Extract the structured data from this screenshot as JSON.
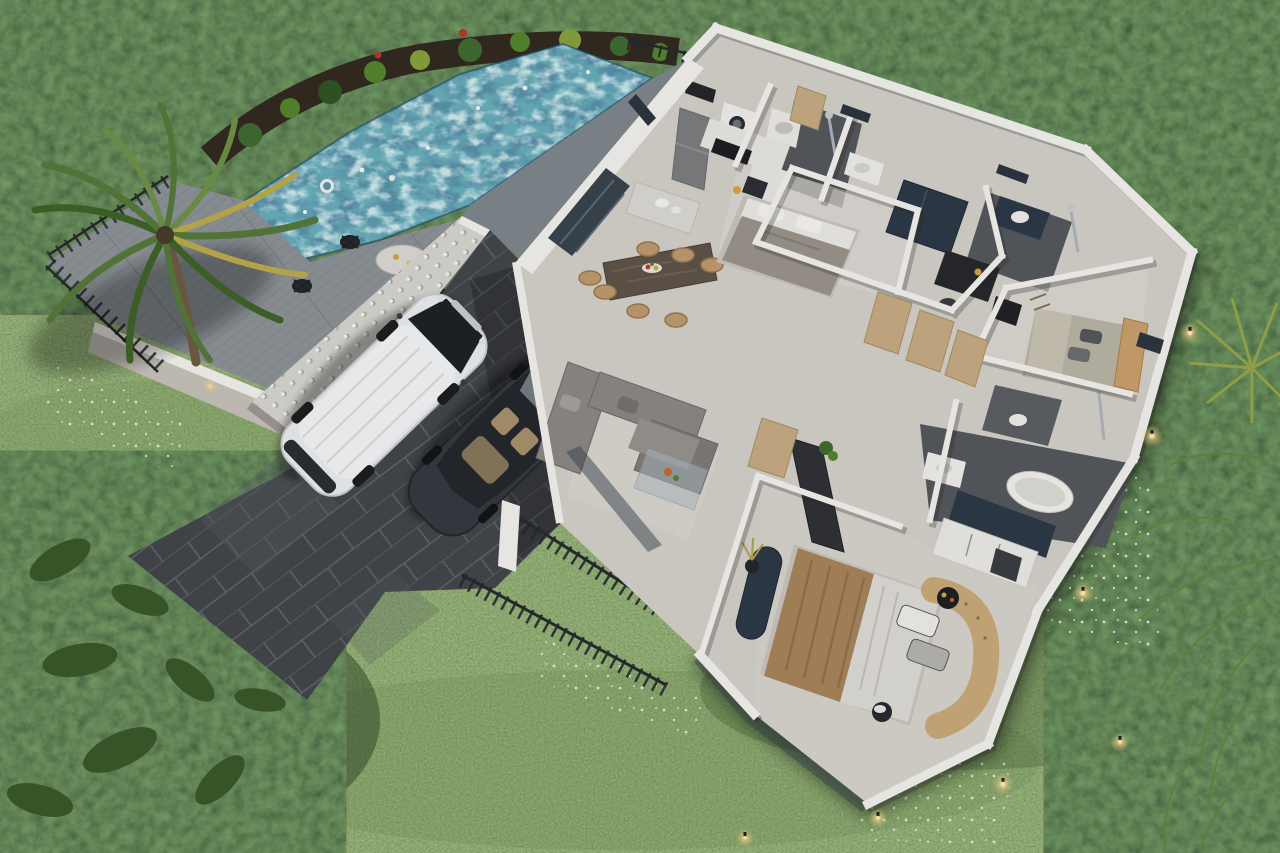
{
  "scene": {
    "title": "Aerial 3D cutaway render of a single-storey pool villa floor plan",
    "style": "photorealistic dollhouse top-down view, no visible text or UI",
    "areas": {
      "garden": {
        "label": "Lawn and tropical garden with hedges, palm tree, leafy beds and white ground flowers"
      },
      "pool": {
        "label": "Infinity lap pool with mottled blue tiles, planting strip and black fence"
      },
      "deck": {
        "label": "Grey timber sun deck with round marble table and black wire chairs"
      },
      "breeze_wall": {
        "label": "White decorative breeze-block privacy wall"
      },
      "carport": {
        "label": "Slate-paved carport and driveway with two parked cars"
      },
      "terrace": {
        "label": "Entry terrace with black railings, pillar and planter"
      },
      "house": {
        "label": "Open-plan villa interior with cutaway walls"
      }
    },
    "rooms": [
      {
        "name": "kitchen-laundry",
        "features": [
          "grey retro fridge",
          "black cooktop",
          "sink",
          "island with plates",
          "front-load washer",
          "top-load washer"
        ]
      },
      {
        "name": "dining-area",
        "features": [
          "dark stone-top table",
          "seven tan chairs",
          "fruit platter"
        ]
      },
      {
        "name": "living-room",
        "features": [
          "grey L-shaped sectional",
          "glass coffee table with flowers",
          "dark wood sideboard",
          "plants"
        ]
      },
      {
        "name": "bedroom-1",
        "features": [
          "double bed with grey blanket",
          "white pillows",
          "dark wardrobe"
        ]
      },
      {
        "name": "bathroom-1",
        "features": [
          "walk-in shower",
          "white basin",
          "dark tiled floor"
        ]
      },
      {
        "name": "office-nook",
        "features": [
          "dark desk",
          "chair",
          "lamp"
        ]
      },
      {
        "name": "bedroom-2",
        "features": [
          "bed with tan bolster headboard",
          "sage bedding"
        ]
      },
      {
        "name": "bathroom-2",
        "features": [
          "basin on dark counter",
          "shower column"
        ]
      },
      {
        "name": "hallway",
        "features": [
          "three light-wood doors",
          "door near master suite"
        ]
      },
      {
        "name": "master-bedroom",
        "features": [
          "king bed with brown throw",
          "curved tan chesterfield sofa",
          "navy chaise with dried plant",
          "round side table",
          "stool"
        ]
      },
      {
        "name": "master-bathroom",
        "features": [
          "freestanding oval tub",
          "basin",
          "shower column",
          "navy and white wardrobe cabinets"
        ]
      }
    ],
    "vehicles": [
      {
        "type": "minivan",
        "color": "white"
      },
      {
        "type": "sedan",
        "color": "dark grey",
        "detail": "tan interior visible through glass roof"
      }
    ],
    "outdoor_details": {
      "garden_lights": 7,
      "deck_wall_lights": 2,
      "pool_float_rings": 2,
      "white_flower_beds": 4,
      "palm_trees": 2
    },
    "palette": {
      "lawn": "#4e6e36",
      "lawn_light": "#5f8242",
      "hedge": "#1f3619",
      "leafbed": "#243c1c",
      "soil": "#32291f",
      "pool_mid": "#69aebc",
      "pool_dark": "#1a4766",
      "pool_light": "#bfe3e6",
      "deck": "#8d9398",
      "deck_dark": "#798086",
      "railing": "#26292d",
      "breeze": "#d7d5d0",
      "slate": "#42464b",
      "grout": "#61666c",
      "stone": "#9da3a8",
      "floor": "#d4d1cb",
      "wet": "#54585d",
      "wall": "#f4f2ed",
      "wall_shade": "#c6c2ba",
      "glass": "#39434d",
      "wood_door": "#c6ac84",
      "wood_table": "#5f5347",
      "chair": "#bf9a6c",
      "sofa": "#8b8885",
      "bed_white": "#e2dfda",
      "blanket": "#9a948b",
      "drape": "#a8845c",
      "tan_sofa": "#d2b183",
      "navy": "#2d3947",
      "car_white": "#eaecee",
      "car_dark": "#35393f",
      "glow": "#f3d281",
      "palm": "#5d8038",
      "palm_yellow": "#b3a345",
      "trunk": "#6f5a44"
    }
  }
}
